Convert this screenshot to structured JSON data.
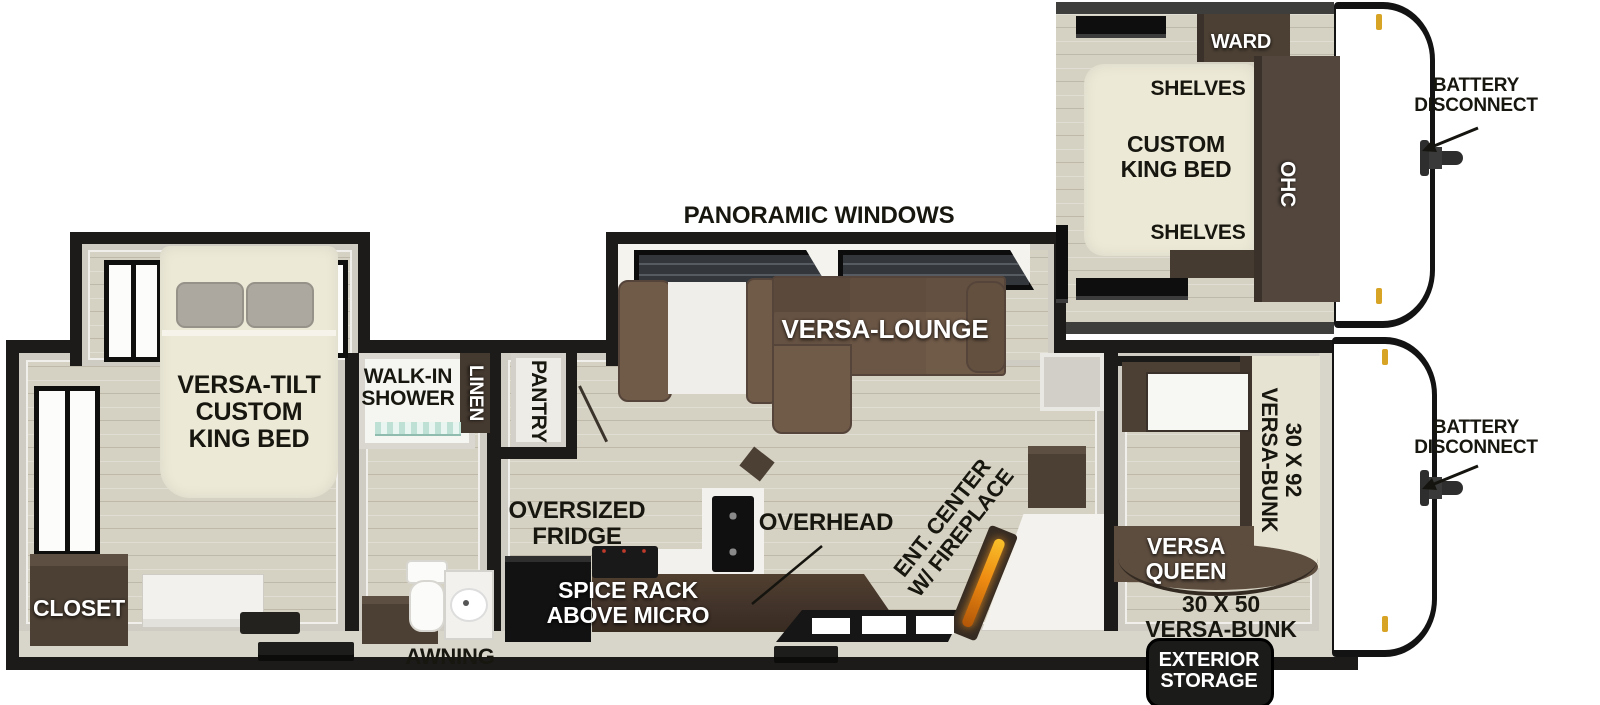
{
  "inset": {
    "ward": "WARD",
    "shelves_top": "SHELVES",
    "bed": "CUSTOM\nKING BED",
    "ohc": "OHC",
    "shelves_bottom": "SHELVES",
    "battery_disconnect": "BATTERY\nDISCONNECT"
  },
  "plan": {
    "panoramic_windows": "PANORAMIC WINDOWS",
    "versa_lounge": "VERSA-LOUNGE",
    "master_bed": "VERSA-TILT\nCUSTOM\nKING BED",
    "closet": "CLOSET",
    "walk_in_shower": "WALK-IN\nSHOWER",
    "linen": "LINEN",
    "pantry": "PANTRY",
    "oversized_fridge": "OVERSIZED\nFRIDGE",
    "spice_rack": "SPICE RACK\nABOVE MICRO",
    "overhead": "OVERHEAD",
    "ent_center": "ENT. CENTER\nW/ FIREPLACE",
    "bunk_30x92": "30 X 92\nVERSA-BUNK",
    "versa_queen": "VERSA\nQUEEN",
    "bunk_30x50": "30 X 50\nVERSA-BUNK",
    "battery_disconnect": "BATTERY\nDISCONNECT",
    "awning": "AWNING",
    "exterior_storage": "EXTERIOR\nSTORAGE"
  },
  "colors": {
    "wall_black": "#1c1b19",
    "floor": "#d6d2c3",
    "cabinet_brown": "#4c4034",
    "sofa_brown": "#705a48",
    "bed_cream": "#ece9d7",
    "flame_orange": "#ee8c12",
    "marker_yellow": "#d8a426",
    "glass_teal": "#bfe0d4",
    "window_dark": "#33373c"
  }
}
